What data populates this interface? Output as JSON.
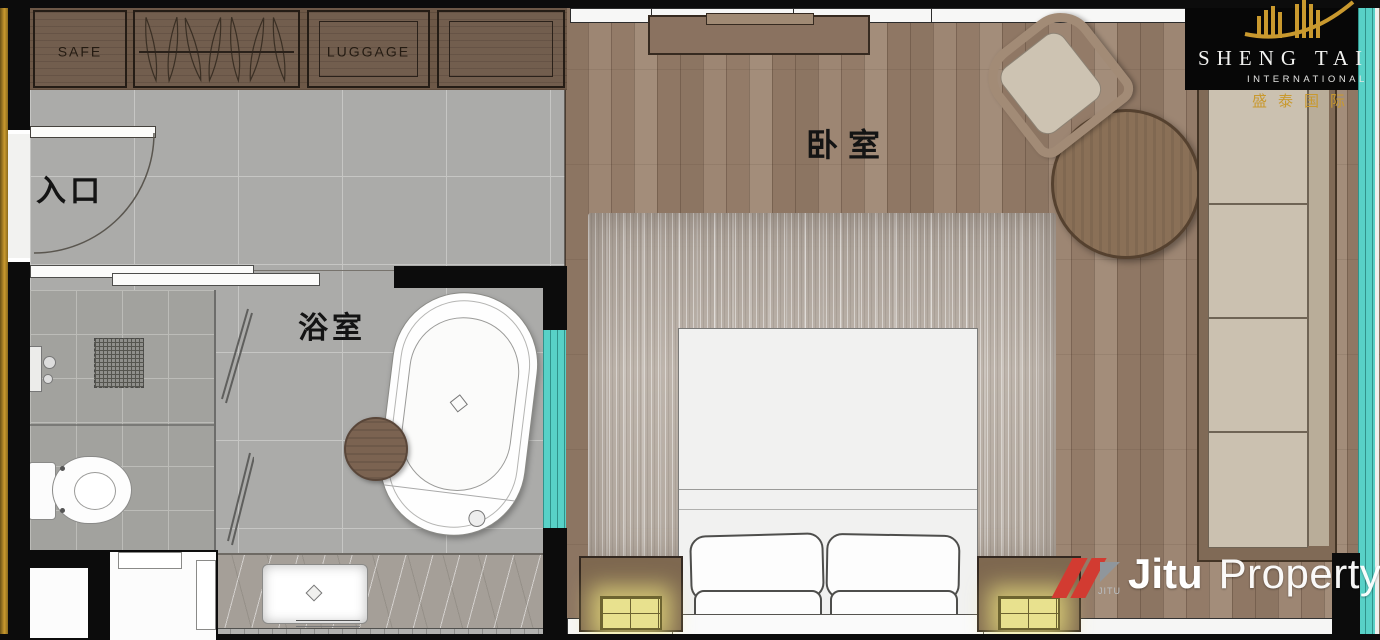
{
  "plan": {
    "rooms": {
      "entrance": "入口",
      "bathroom": "浴室",
      "bedroom": "卧室"
    },
    "closet": {
      "safe": "SAFE",
      "luggage": "LUGGAGE"
    }
  },
  "branding": {
    "shengtai": {
      "name": "SHENG TAI",
      "subtitle": "INTERNATIONAL",
      "chinese": "盛泰国际"
    },
    "jitu": {
      "brand": "Jitu",
      "suffix": "Property",
      "icon_text": "JITU"
    }
  },
  "colors": {
    "gold": "#c9992e",
    "teal": "#58d1c7",
    "jitu_red": "#d23b31",
    "wall": "#0c0c0c",
    "wood_floor": "#97806d",
    "tile_floor": "#ababa9",
    "rug": "#b7ada4",
    "sofa_cushion": "#cbc1b0",
    "vanity_marble": "#a59f98",
    "lamp_glow": "#ece285"
  }
}
